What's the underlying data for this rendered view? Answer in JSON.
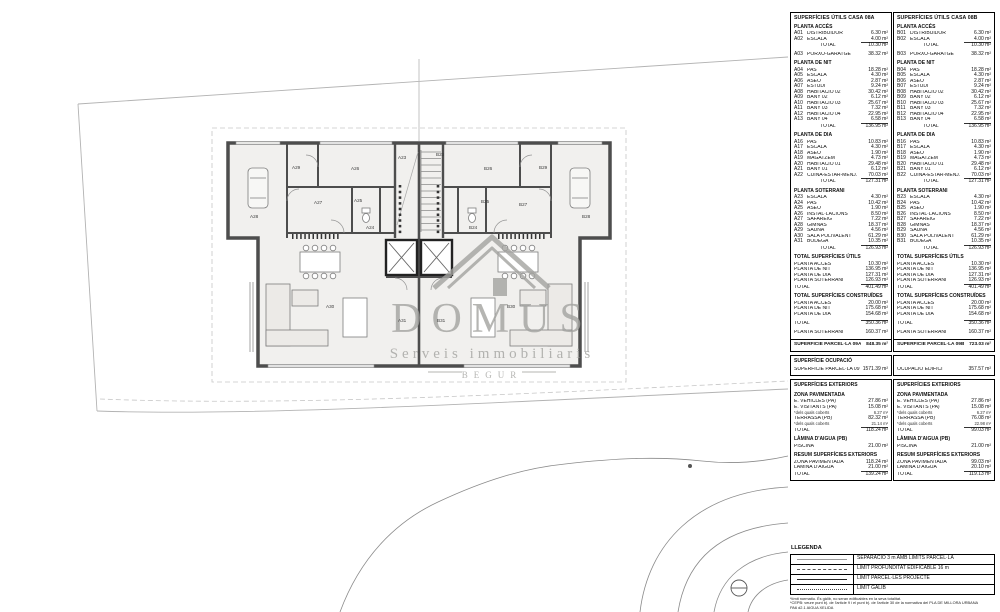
{
  "watermark": {
    "title": "DOMUS",
    "subtitle": "Serveis immobiliaris",
    "city": "BEGUR"
  },
  "tables": {
    "casa_a": {
      "title": "SUPERFÍCIES ÚTILS CASA 08A",
      "sections": [
        {
          "header": "PLANTA ACCÉS",
          "rows": [
            {
              "c": "A01",
              "l": "DISTRIBUIDOR",
              "v": "6.30 m²"
            },
            {
              "c": "A02",
              "l": "ESCALA",
              "v": "4.00 m²"
            },
            {
              "l": "TOTAL",
              "v": "10.30 m²",
              "total": true
            },
            {
              "c": "A03",
              "l": "PORXO-GARATGE",
              "v": "38.32 m²",
              "gap": true
            }
          ]
        },
        {
          "header": "PLANTA DE NIT",
          "rows": [
            {
              "c": "A04",
              "l": "PAS",
              "v": "18.28 m²"
            },
            {
              "c": "A05",
              "l": "ESCALA",
              "v": "4.30 m²"
            },
            {
              "c": "A06",
              "l": "ASEO",
              "v": "2.87 m²"
            },
            {
              "c": "A07",
              "l": "ESTUDI",
              "v": "9.24 m²"
            },
            {
              "c": "A08",
              "l": "HABITACIÓ 02",
              "v": "30.42 m²"
            },
            {
              "c": "A09",
              "l": "BANY 02",
              "v": "6.12 m²"
            },
            {
              "c": "A10",
              "l": "HABITACIÓ 03",
              "v": "25.67 m²"
            },
            {
              "c": "A11",
              "l": "BANY 03",
              "v": "7.32 m²"
            },
            {
              "c": "A12",
              "l": "HABITACIÓ 04",
              "v": "22.95 m²"
            },
            {
              "c": "A13",
              "l": "BANY 04",
              "v": "6.58 m²"
            },
            {
              "l": "TOTAL",
              "v": "136.95 m²",
              "total": true
            }
          ]
        },
        {
          "header": "PLANTA DE DIA",
          "rows": [
            {
              "c": "A16",
              "l": "PAS",
              "v": "10.83 m²"
            },
            {
              "c": "A17",
              "l": "ESCALA",
              "v": "4.30 m²"
            },
            {
              "c": "A18",
              "l": "ASEO",
              "v": "1.90 m²"
            },
            {
              "c": "A19",
              "l": "MAGATZEM",
              "v": "4.73 m²"
            },
            {
              "c": "A20",
              "l": "HABITACIÓ 01",
              "v": "29.48 m²"
            },
            {
              "c": "A21",
              "l": "BANY 01",
              "v": "6.12 m²"
            },
            {
              "c": "A22",
              "l": "CUINA-ESTAR-MENJ.",
              "v": "70.03 m²"
            },
            {
              "l": "TOTAL",
              "v": "127.31 m²",
              "total": true
            }
          ]
        },
        {
          "header": "PLANTA SOTERRANI",
          "rows": [
            {
              "c": "A23",
              "l": "ESCALA",
              "v": "4.30 m²"
            },
            {
              "c": "A24",
              "l": "PAS",
              "v": "10.42 m²"
            },
            {
              "c": "A25",
              "l": "ASEO",
              "v": "1.90 m²"
            },
            {
              "c": "A26",
              "l": "INSTAL·LACIONS",
              "v": "8.50 m²"
            },
            {
              "c": "A27",
              "l": "SAFAREIG",
              "v": "7.22 m²"
            },
            {
              "c": "A28",
              "l": "GIMNÀS",
              "v": "18.37 m²"
            },
            {
              "c": "A29",
              "l": "SAUNA",
              "v": "4.56 m²"
            },
            {
              "c": "A30",
              "l": "SALA POLIVALENT",
              "v": "61.29 m²"
            },
            {
              "c": "A31",
              "l": "BODEGA",
              "v": "10.35 m²"
            },
            {
              "l": "TOTAL",
              "v": "126.93 m²",
              "total": true
            }
          ]
        },
        {
          "header": "TOTAL SUPERFÍCIES ÚTILS",
          "rows": [
            {
              "l": "PLANTA ACCÉS",
              "v": "10.30 m²",
              "noind": true
            },
            {
              "l": "PLANTA DE NIT",
              "v": "136.95 m²",
              "noind": true
            },
            {
              "l": "PLANTA DE DIA",
              "v": "127.31 m²",
              "noind": true
            },
            {
              "l": "PLANTA SOTERRANI",
              "v": "126.93 m²",
              "noind": true
            },
            {
              "l": "TOTAL",
              "v": "401.49 m²",
              "total": true,
              "noind": true
            }
          ]
        },
        {
          "header": "TOTAL SUPERFÍCIES CONSTRUÏDES",
          "rows": [
            {
              "l": "PLANTA ACCÉS",
              "v": "20.00 m²",
              "noind": true
            },
            {
              "l": "PLANTA DE NIT",
              "v": "175.68 m²",
              "noind": true
            },
            {
              "l": "PLANTA DE DIA",
              "v": "154.68 m²",
              "noind": true
            },
            {
              "l": "TOTAL",
              "v": "350.36 m²",
              "total": true,
              "noind": true,
              "gap": true
            },
            {
              "l": "PLANTA SOTERRANI",
              "v": "160.37 m²",
              "noind": true,
              "gap": true
            }
          ]
        }
      ],
      "parcel": {
        "l": "SUPERFÍCIE PARCEL·LA 09A",
        "v": "848.35 m²"
      },
      "ocupacio": {
        "header": "SUPERFÍCIE OCUPACIÓ",
        "rows": [
          {
            "l": "SUPERFÍCIE PARCEL·LA 09",
            "v": "1571.39 m²",
            "noind": true
          }
        ]
      },
      "exteriors": {
        "header": "SUPERFÍCIES EXTERIORS",
        "groups": [
          {
            "sub": "ZONA PAVIMENTADA",
            "rows": [
              {
                "l": "E. VEHICLES (PA)",
                "v": "27.86 m²",
                "noind": true
              },
              {
                "l": "E. VISITANTS (PA)",
                "v": "15.08 m²",
                "noind": true
              },
              {
                "l": "*dels quals coberts",
                "v": "6.27 m²",
                "small": true,
                "noind": true
              },
              {
                "l": "TERRASSA (PB)",
                "v": "82.32 m²",
                "noind": true
              },
              {
                "l": "*dels quals coberts",
                "v": "21.14 m²",
                "small": true,
                "noind": true
              },
              {
                "l": "TOTAL",
                "v": "118.24 m²",
                "total": true,
                "noind": true
              }
            ]
          },
          {
            "sub": "LÀMINA D'AIGUA (PB)",
            "rows": [
              {
                "l": "PISCINA",
                "v": "21.00 m²",
                "noind": true
              }
            ]
          },
          {
            "sub": "RESUM SUPERFÍCIES EXTERIORS",
            "rows": [
              {
                "l": "ZONA PAVIMENTADA",
                "v": "118.24 m²",
                "noind": true
              },
              {
                "l": "LÀMINA D'AIGUA",
                "v": "21.00 m²",
                "noind": true
              },
              {
                "l": "TOTAL",
                "v": "139.24 m²",
                "total": true,
                "noind": true
              }
            ]
          }
        ]
      }
    },
    "casa_b": {
      "title": "SUPERFÍCIES ÚTILS CASA 08B",
      "sections": [
        {
          "header": "PLANTA ACCÉS",
          "rows": [
            {
              "c": "B01",
              "l": "DISTRIBUIDOR",
              "v": "6.30 m²"
            },
            {
              "c": "B02",
              "l": "ESCALA",
              "v": "4.00 m²"
            },
            {
              "l": "TOTAL",
              "v": "10.30 m²",
              "total": true
            },
            {
              "c": "B03",
              "l": "PORXO-GARATGE",
              "v": "38.32 m²",
              "gap": true
            }
          ]
        },
        {
          "header": "PLANTA DE NIT",
          "rows": [
            {
              "c": "B04",
              "l": "PAS",
              "v": "18.28 m²"
            },
            {
              "c": "B05",
              "l": "ESCALA",
              "v": "4.30 m²"
            },
            {
              "c": "B06",
              "l": "ASEO",
              "v": "2.87 m²"
            },
            {
              "c": "B07",
              "l": "ESTUDI",
              "v": "9.24 m²"
            },
            {
              "c": "B08",
              "l": "HABITACIÓ 02",
              "v": "30.42 m²"
            },
            {
              "c": "B09",
              "l": "BANY 02",
              "v": "6.12 m²"
            },
            {
              "c": "B10",
              "l": "HABITACIÓ 03",
              "v": "25.67 m²"
            },
            {
              "c": "B11",
              "l": "BANY 03",
              "v": "7.32 m²"
            },
            {
              "c": "B12",
              "l": "HABITACIÓ 04",
              "v": "22.95 m²"
            },
            {
              "c": "B13",
              "l": "BANY 04",
              "v": "6.58 m²"
            },
            {
              "l": "TOTAL",
              "v": "136.95 m²",
              "total": true
            }
          ]
        },
        {
          "header": "PLANTA DE DIA",
          "rows": [
            {
              "c": "B16",
              "l": "PAS",
              "v": "10.83 m²"
            },
            {
              "c": "B17",
              "l": "ESCALA",
              "v": "4.30 m²"
            },
            {
              "c": "B18",
              "l": "ASEO",
              "v": "1.90 m²"
            },
            {
              "c": "B19",
              "l": "MAGATZEM",
              "v": "4.73 m²"
            },
            {
              "c": "B20",
              "l": "HABITACIÓ 01",
              "v": "29.48 m²"
            },
            {
              "c": "B21",
              "l": "BANY 01",
              "v": "6.12 m²"
            },
            {
              "c": "B22",
              "l": "CUINA-ESTAR-MENJ.",
              "v": "70.03 m²"
            },
            {
              "l": "TOTAL",
              "v": "127.31 m²",
              "total": true
            }
          ]
        },
        {
          "header": "PLANTA SOTERRANI",
          "rows": [
            {
              "c": "B23",
              "l": "ESCALA",
              "v": "4.30 m²"
            },
            {
              "c": "B24",
              "l": "PAS",
              "v": "10.42 m²"
            },
            {
              "c": "B25",
              "l": "ASEO",
              "v": "1.90 m²"
            },
            {
              "c": "B26",
              "l": "INSTAL·LACIONS",
              "v": "8.50 m²"
            },
            {
              "c": "B27",
              "l": "SAFAREIG",
              "v": "7.22 m²"
            },
            {
              "c": "B28",
              "l": "GIMNÀS",
              "v": "18.37 m²"
            },
            {
              "c": "B29",
              "l": "SAUNA",
              "v": "4.56 m²"
            },
            {
              "c": "B30",
              "l": "SALA POLIVALENT",
              "v": "61.29 m²"
            },
            {
              "c": "B31",
              "l": "BODEGA",
              "v": "10.35 m²"
            },
            {
              "l": "TOTAL",
              "v": "126.93 m²",
              "total": true
            }
          ]
        },
        {
          "header": "TOTAL SUPERFÍCIES ÚTILS",
          "rows": [
            {
              "l": "PLANTA ACCÉS",
              "v": "10.30 m²",
              "noind": true
            },
            {
              "l": "PLANTA DE NIT",
              "v": "136.95 m²",
              "noind": true
            },
            {
              "l": "PLANTA DE DIA",
              "v": "127.31 m²",
              "noind": true
            },
            {
              "l": "PLANTA SOTERRANI",
              "v": "126.93 m²",
              "noind": true
            },
            {
              "l": "TOTAL",
              "v": "401.49 m²",
              "total": true,
              "noind": true
            }
          ]
        },
        {
          "header": "TOTAL SUPERFÍCIES CONSTRUÏDES",
          "rows": [
            {
              "l": "PLANTA ACCÉS",
              "v": "20.00 m²",
              "noind": true
            },
            {
              "l": "PLANTA DE NIT",
              "v": "175.68 m²",
              "noind": true
            },
            {
              "l": "PLANTA DE DIA",
              "v": "154.68 m²",
              "noind": true
            },
            {
              "l": "TOTAL",
              "v": "350.36 m²",
              "total": true,
              "noind": true,
              "gap": true
            },
            {
              "l": "PLANTA SOTERRANI",
              "v": "160.37 m²",
              "noind": true,
              "gap": true
            }
          ]
        }
      ],
      "parcel": {
        "l": "SUPERFÍCIE PARCEL·LA 09B",
        "v": "723.03 m²"
      },
      "ocupacio": {
        "header": "",
        "rows": [
          {
            "l": "OCUPACIÓ EDIFICI",
            "v": "357.57 m²",
            "noind": true
          }
        ]
      },
      "exteriors": {
        "header": "SUPERFÍCIES EXTERIORS",
        "groups": [
          {
            "sub": "ZONA PAVIMENTADA",
            "rows": [
              {
                "l": "E. VEHICLES (PA)",
                "v": "27.86 m²",
                "noind": true
              },
              {
                "l": "E. VISITANTS (PA)",
                "v": "15.08 m²",
                "noind": true
              },
              {
                "l": "*dels quals coberts",
                "v": "6.27 m²",
                "small": true,
                "noind": true
              },
              {
                "l": "TERRASSA (PB)",
                "v": "76.08 m²",
                "noind": true
              },
              {
                "l": "*dels quals coberts",
                "v": "22.98 m²",
                "small": true,
                "noind": true
              },
              {
                "l": "TOTAL",
                "v": "99.03 m²",
                "total": true,
                "noind": true
              }
            ]
          },
          {
            "sub": "LÀMINA D'AIGUA (PB)",
            "rows": [
              {
                "l": "PISCINA",
                "v": "21.00 m²",
                "noind": true
              }
            ]
          },
          {
            "sub": "RESUM SUPERFÍCIES EXTERIORS",
            "rows": [
              {
                "l": "ZONA PAVIMENTADA",
                "v": "99.03 m²",
                "noind": true
              },
              {
                "l": "LÀMINA D'AIGUA",
                "v": "20.10 m²",
                "noind": true
              },
              {
                "l": "TOTAL",
                "v": "119.13 m²",
                "total": true,
                "noind": true
              }
            ]
          }
        ]
      }
    }
  },
  "legend": {
    "title": "LLEGENDA",
    "items": [
      {
        "style": "thin",
        "label": "SEPARACIÓ 3 m AMB LÍMITS PARCEL·LA"
      },
      {
        "style": "dashed",
        "label": "LÍMIT PROFUNDITAT EDIFICABLE 16 m"
      },
      {
        "style": "solid",
        "label": "LÍMIT PARCEL·LES PROJECTE"
      },
      {
        "style": "dashdot",
        "label": "LÍMIT GÀLIB"
      }
    ],
    "notes": [
      "*límit normatiu. És gàlib, no seran edificables en la seva totalitat.",
      "*CEPB: veure punt b). de l'article 9 i el punt b). de l'article 30 de la normativa del PLA DE MILLORA URBANA",
      "PA6 d2.1 AIGUA XELIDA"
    ]
  },
  "plan": {
    "labels": [
      {
        "x": 292,
        "y": 165,
        "t": "A29"
      },
      {
        "x": 351,
        "y": 166,
        "t": "A26"
      },
      {
        "x": 398,
        "y": 155,
        "t": "A23"
      },
      {
        "x": 436,
        "y": 152,
        "t": "B23"
      },
      {
        "x": 484,
        "y": 166,
        "t": "B26"
      },
      {
        "x": 539,
        "y": 165,
        "t": "B29"
      },
      {
        "x": 250,
        "y": 214,
        "t": "A28"
      },
      {
        "x": 314,
        "y": 200,
        "t": "A27"
      },
      {
        "x": 354,
        "y": 198,
        "t": "A25"
      },
      {
        "x": 481,
        "y": 199,
        "t": "B25"
      },
      {
        "x": 519,
        "y": 202,
        "t": "B27"
      },
      {
        "x": 582,
        "y": 214,
        "t": "B28"
      },
      {
        "x": 366,
        "y": 225,
        "t": "A24"
      },
      {
        "x": 469,
        "y": 225,
        "t": "B24"
      },
      {
        "x": 326,
        "y": 304,
        "t": "A30"
      },
      {
        "x": 398,
        "y": 318,
        "t": "A31"
      },
      {
        "x": 437,
        "y": 318,
        "t": "B31"
      },
      {
        "x": 507,
        "y": 304,
        "t": "B30"
      }
    ]
  }
}
